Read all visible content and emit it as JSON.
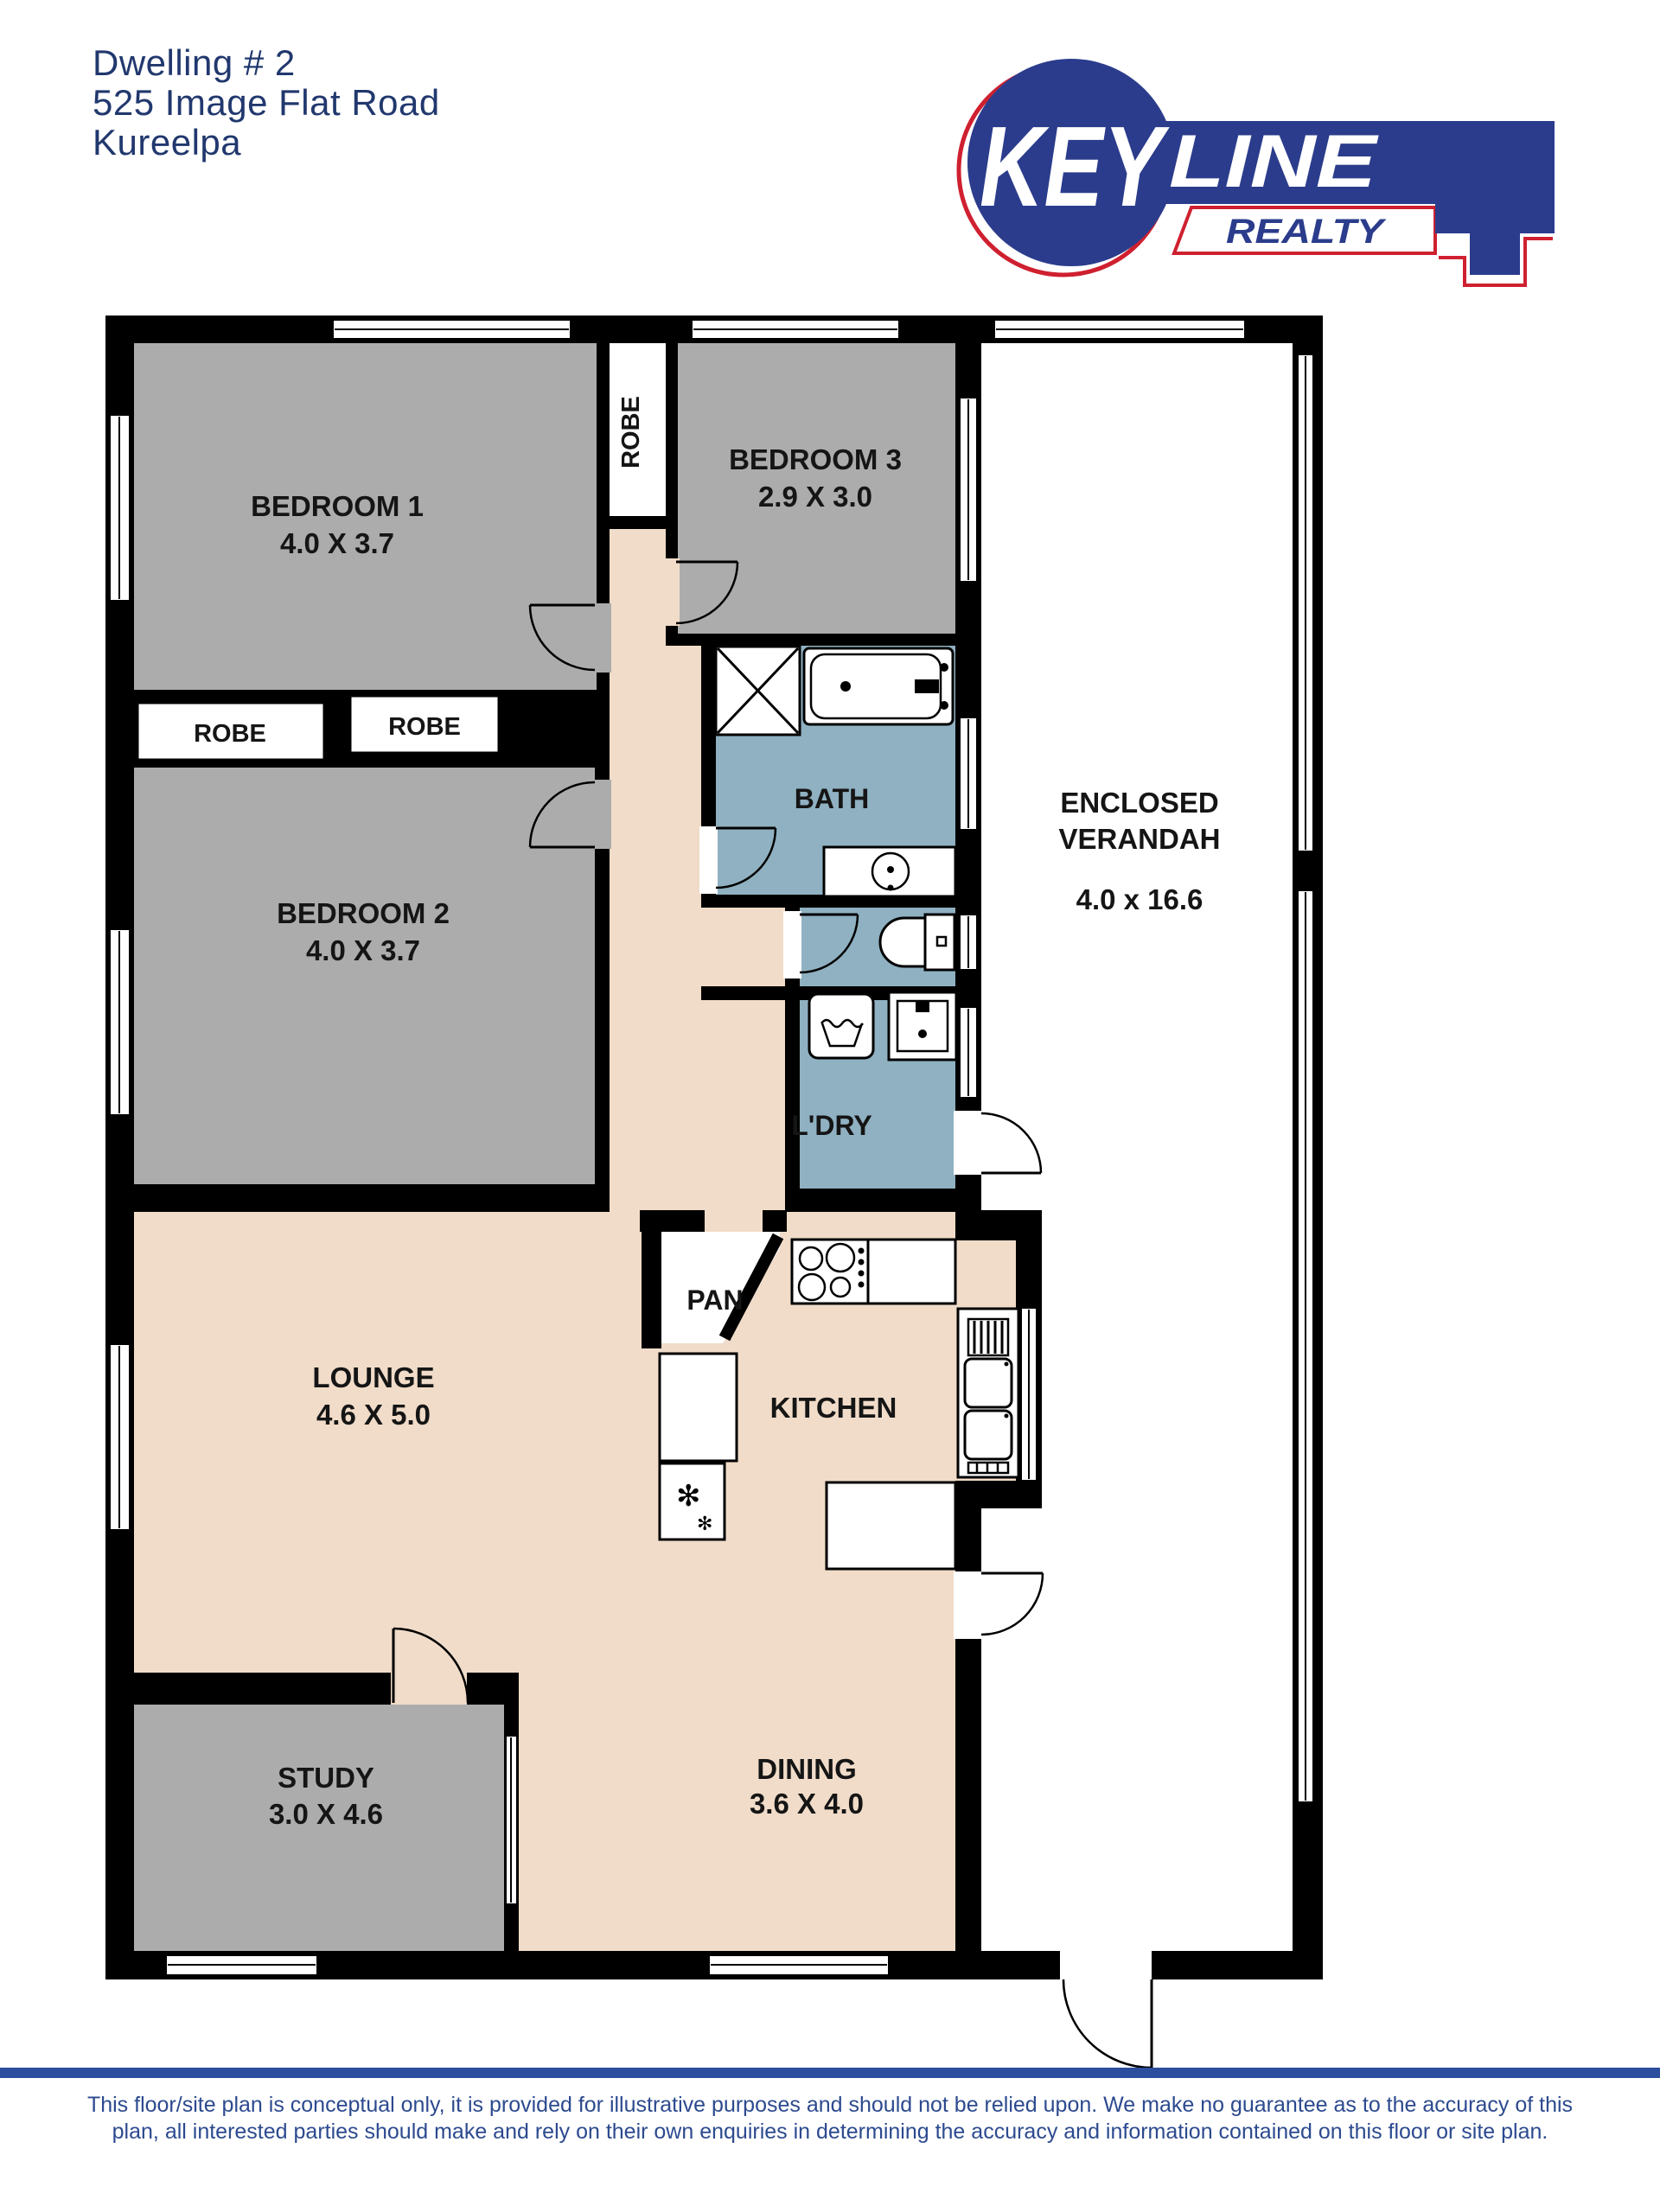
{
  "header": {
    "title_lines": [
      "Dwelling # 2",
      "525 Image Flat Road",
      "Kureelpa"
    ],
    "title_color": "#21386e"
  },
  "logo": {
    "key": "KEY",
    "line": "LINE",
    "realty": "REALTY",
    "brand_blue": "#2b3c8c",
    "brand_red": "#cf2030"
  },
  "plan": {
    "rooms": {
      "bedroom1": {
        "label": "BEDROOM 1",
        "dims": "4.0 X 3.7"
      },
      "bedroom2": {
        "label": "BEDROOM 2",
        "dims": "4.0 X 3.7"
      },
      "bedroom3": {
        "label": "BEDROOM 3",
        "dims": "2.9 X 3.0"
      },
      "robe_top": {
        "label": "ROBE"
      },
      "robe_left": {
        "label": "ROBE"
      },
      "robe_right": {
        "label": "ROBE"
      },
      "bath": {
        "label": "BATH"
      },
      "laundry": {
        "label": "L'DRY"
      },
      "verandah": {
        "label_line1": "ENCLOSED",
        "label_line2": "VERANDAH",
        "dims": "4.0 x 16.6"
      },
      "lounge": {
        "label": "LOUNGE",
        "dims": "4.6 X 5.0"
      },
      "pantry": {
        "label": "PAN"
      },
      "kitchen": {
        "label": "KITCHEN"
      },
      "study": {
        "label": "STUDY",
        "dims": "3.0 X 4.6"
      },
      "dining": {
        "label": "DINING",
        "dims": "3.6 X 4.0"
      }
    },
    "fixtures": [
      "shower",
      "bathtub",
      "vanity-basin",
      "toilet",
      "washing-machine",
      "laundry-tub",
      "cooktop",
      "fridge",
      "oven-tower",
      "kitchen-bench"
    ],
    "colors": {
      "wall": "#000000",
      "floor_timber": "#f0dcc9",
      "bedroom_gray": "#acacac",
      "wet_area_blue": "#8fb1c1",
      "background": "#ffffff"
    }
  },
  "footer": {
    "divider_color": "#2b4e9e",
    "text_color": "#2c4a8f",
    "disclaimer_line1": "This floor/site plan is conceptual only, it is provided for illustrative purposes and should not be relied upon.  We make no guarantee as to the accuracy of this",
    "disclaimer_line2": "plan, all interested parties should make and rely on their own enquiries in determining the accuracy and information contained on this floor or site plan."
  }
}
